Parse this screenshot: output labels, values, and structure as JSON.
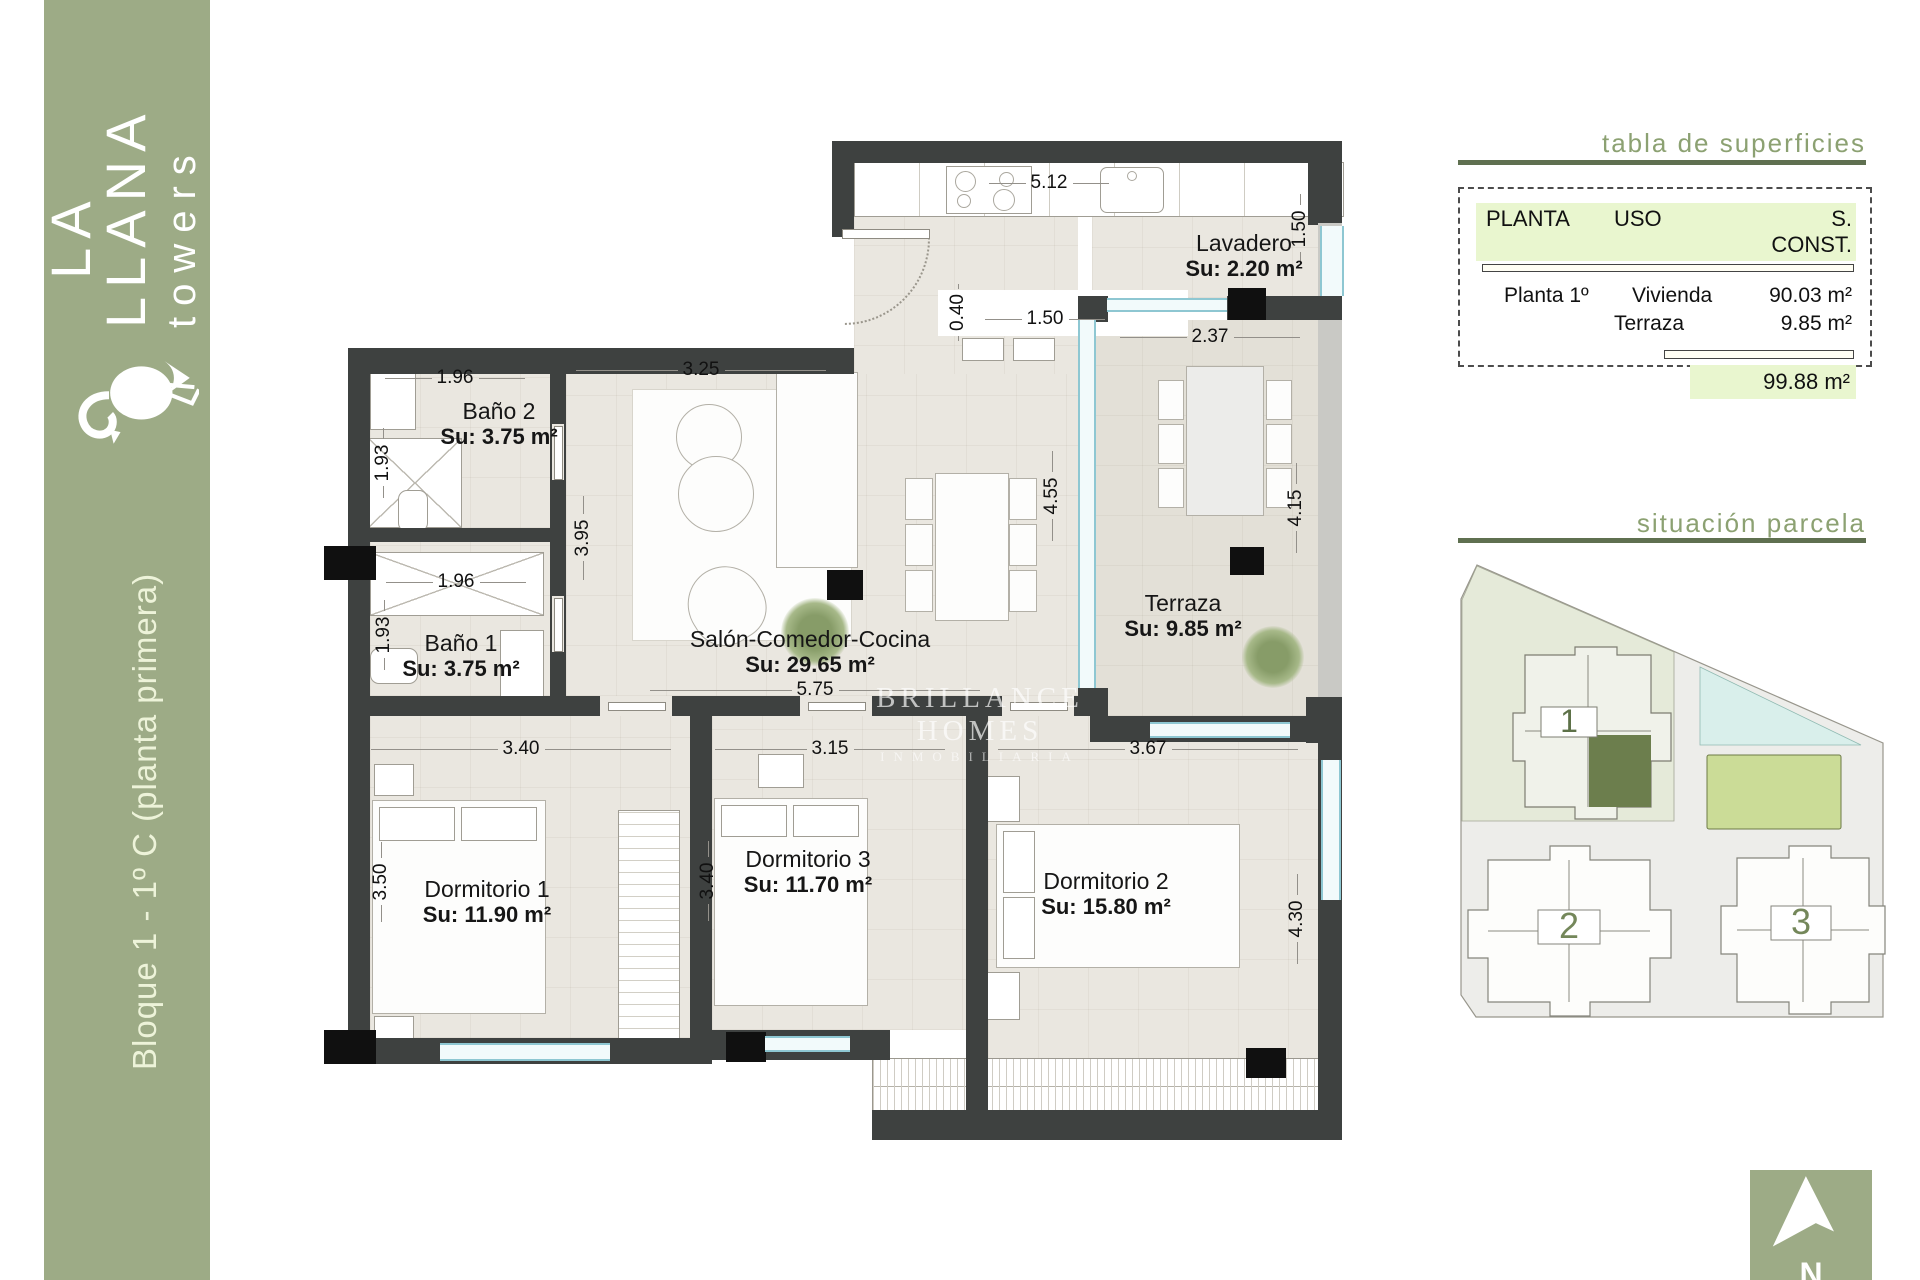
{
  "sidebar": {
    "brand_big": "  LA\nLLANA",
    "brand_sub": "towers",
    "unit_label": "Bloque 1 - 1º C (planta primera)"
  },
  "surfaces": {
    "title": "tabla de superficies",
    "col_planta": "PLANTA",
    "col_uso": "USO",
    "col_sconst": "S. CONST.",
    "row1_planta": "Planta 1º",
    "row1_uso": "Vivienda",
    "row1_val": "90.03 m²",
    "row2_uso": "Terraza",
    "row2_val": "9.85 m²",
    "total": "99.88 m²"
  },
  "site": {
    "title": "situación parcela",
    "block1": "1",
    "block2": "2",
    "block3": "3",
    "north": "N"
  },
  "watermark": {
    "line1": "BRILLANCE HOMES",
    "line2": "INMOBILIARIA"
  },
  "plan": {
    "rooms": [
      {
        "name": "Lavadero",
        "area": "Su: 2.20 m²"
      },
      {
        "name": "Baño 2",
        "area": "Su: 3.75 m²"
      },
      {
        "name": "Baño 1",
        "area": "Su: 3.75 m²"
      },
      {
        "name": "Salón-Comedor-Cocina",
        "area": "Su: 29.65 m²"
      },
      {
        "name": "Terraza",
        "area": "Su: 9.85 m²"
      },
      {
        "name": "Dormitorio 1",
        "area": "Su: 11.90 m²"
      },
      {
        "name": "Dormitorio 3",
        "area": "Su: 11.70 m²"
      },
      {
        "name": "Dormitorio 2",
        "area": "Su: 15.80 m²"
      }
    ],
    "dims": [
      "5.12",
      "1.50",
      "0.40",
      "1.50",
      "2.37",
      "1.96",
      "3.25",
      "1.93",
      "3.95",
      "1.96",
      "1.93",
      "4.55",
      "4.15",
      "5.75",
      "3.40",
      "3.15",
      "3.67",
      "3.50",
      "3.40",
      "4.30"
    ]
  }
}
